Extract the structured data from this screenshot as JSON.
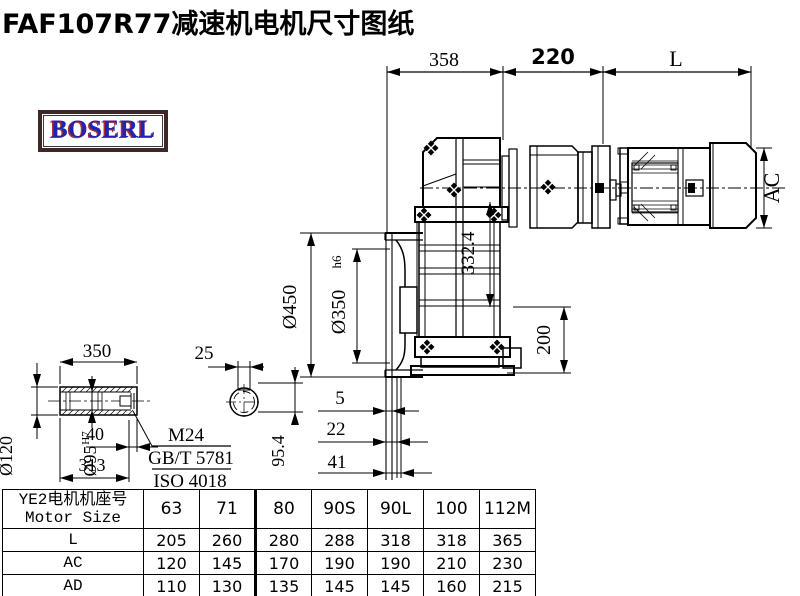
{
  "title": "FAF107R77减速机电机尺寸图纸",
  "logo": {
    "text": "BOSERL"
  },
  "drawing": {
    "dims": {
      "front_width": "358",
      "adapter_width": "220",
      "motor_length": "L",
      "flange_od": "Ø450",
      "spigot": "Ø350",
      "spigot_tol": "h6",
      "center_height": "332.4",
      "base_height": "200",
      "motor_ac": "AC",
      "lip1": "5",
      "lip2": "22",
      "lip3": "41"
    },
    "shaft_detail": {
      "length": "350",
      "keyway_width": "25",
      "od": "Ø120",
      "bore": "Ø95",
      "bore_tol": "H7",
      "thread_depth": "40",
      "usable_length": "313",
      "keyway_height": "95.4",
      "thread": "M24",
      "std1": "GB/T 5781",
      "std2": "ISO 4018"
    }
  },
  "table": {
    "header_line1": "YE2电机机座号",
    "header_line2": "Motor Size",
    "columns": [
      "63",
      "71",
      "80",
      "90S",
      "90L",
      "100",
      "112M"
    ],
    "rows": [
      {
        "label": "L",
        "values": [
          "205",
          "260",
          "280",
          "288",
          "318",
          "318",
          "365"
        ]
      },
      {
        "label": "AC",
        "values": [
          "120",
          "145",
          "170",
          "190",
          "190",
          "210",
          "230"
        ]
      },
      {
        "label": "AD",
        "values": [
          "110",
          "130",
          "135",
          "145",
          "145",
          "160",
          "215"
        ]
      }
    ]
  }
}
